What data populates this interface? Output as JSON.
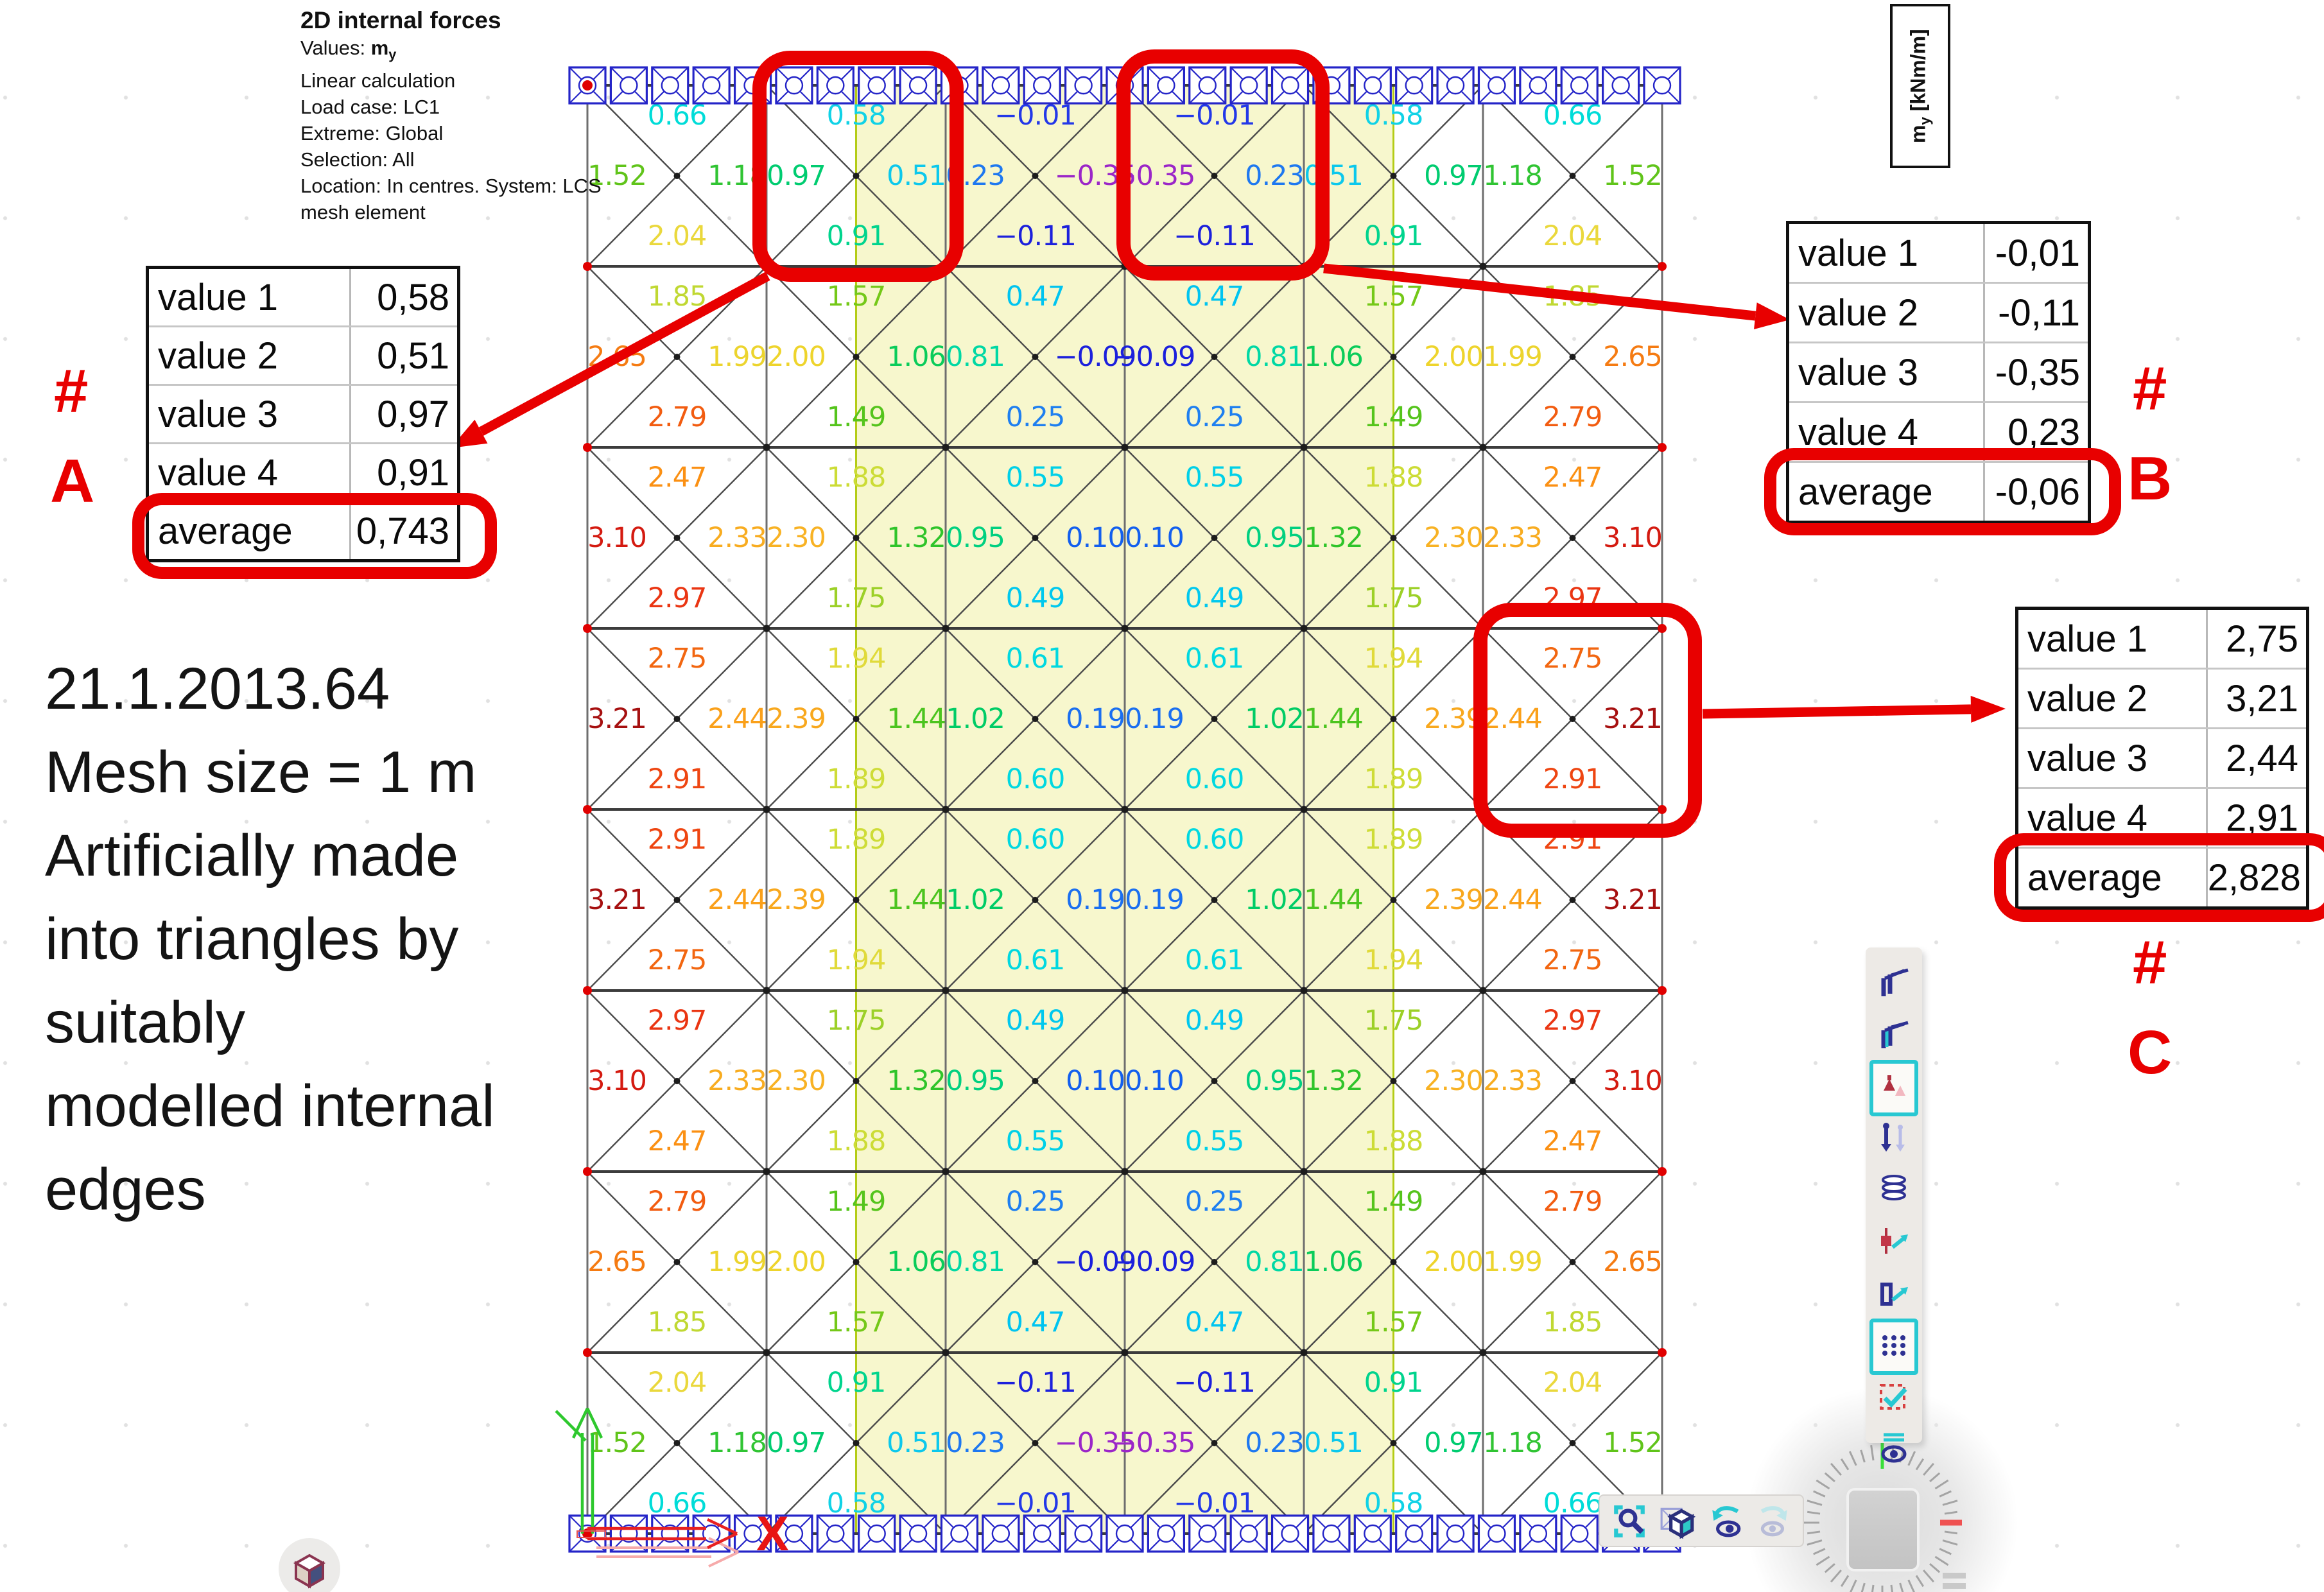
{
  "header": {
    "title": "2D internal forces",
    "values_prefix": "Values: ",
    "values_symbol": "m",
    "values_sub": "y",
    "lines": [
      "Linear calculation",
      "Load case: LC1",
      "Extreme: Global",
      "Selection: All",
      "Location: In centres. System: LCS",
      "mesh element"
    ]
  },
  "unit_box": {
    "symbol": "m",
    "subscript": "y",
    "rest": " [kNm/m]"
  },
  "note_lines": [
    "21.1.2013.64",
    "Mesh size = 1 m",
    "Artificially made",
    "into triangles by",
    "suitably",
    "modelled internal",
    "edges"
  ],
  "annotations": {
    "A": {
      "hash": "#",
      "letter": "A",
      "rows": [
        {
          "label": "value 1",
          "value": "0,58"
        },
        {
          "label": "value 2",
          "value": "0,51"
        },
        {
          "label": "value 3",
          "value": "0,97"
        },
        {
          "label": "value 4",
          "value": "0,91"
        },
        {
          "label": "average",
          "value": "0,743"
        }
      ]
    },
    "B": {
      "hash": "#",
      "letter": "B",
      "rows": [
        {
          "label": "value 1",
          "value": "-0,01"
        },
        {
          "label": "value 2",
          "value": "-0,11"
        },
        {
          "label": "value 3",
          "value": "-0,35"
        },
        {
          "label": "value 4",
          "value": "0,23"
        },
        {
          "label": "average",
          "value": "-0,06"
        }
      ]
    },
    "C": {
      "hash": "#",
      "letter": "C",
      "rows": [
        {
          "label": "value 1",
          "value": "2,75"
        },
        {
          "label": "value 2",
          "value": "3,21"
        },
        {
          "label": "value 3",
          "value": "2,44"
        },
        {
          "label": "value 4",
          "value": "2,91"
        },
        {
          "label": "average",
          "value": "2,828"
        }
      ]
    }
  },
  "axis": {
    "x_label": "X"
  },
  "toolbar_right": {
    "icons": [
      "beam-profile-icon",
      "beam-profile-teal-icon",
      "support-icon",
      "load-arrows-icon",
      "layers-icon",
      "mesh-node-icon",
      "mesh-element-icon",
      "mesh-grid-icon",
      "selection-check-icon",
      "visibility-icon"
    ],
    "highlighted": [
      "support-icon",
      "mesh-grid-icon"
    ]
  },
  "toolbar_bottom": {
    "icons": [
      "zoom-selection-icon",
      "cube-3d-icon",
      "undo-eye-icon",
      "redo-eye-icon"
    ]
  },
  "colors": {
    "accent_red": "#e80000",
    "support_blue": "#2424c8",
    "band_yellow": "#f7f7cd",
    "band_edge": "#b4cc16",
    "grid_dark": "#3c3c3c",
    "grid_gray": "#6e6e6e",
    "node_red": "#e00000",
    "teal": "#28c8d2",
    "navy": "#2e3192"
  },
  "chart_data": {
    "type": "heatmap",
    "title": "2D internal forces my [kNm/m] - FEM plate mesh, 6 x 8 squares of 1 m, each split into 4 triangles",
    "unit": "kNm/m",
    "value_range": [
      -0.35,
      3.21
    ],
    "legend_position": "none",
    "mesh": {
      "cols": 6,
      "rows": 8,
      "mesh_size_m": 1,
      "highlight_band_col_range": [
        1.5,
        4.5
      ],
      "supports": "line supports on top and bottom edges",
      "triangle_values": {
        "top": [
          [
            0.66,
            0.58,
            -0.01,
            -0.01,
            0.58,
            0.66
          ],
          [
            1.85,
            1.57,
            0.47,
            0.47,
            1.57,
            1.85
          ],
          [
            2.47,
            1.88,
            0.55,
            0.55,
            1.88,
            2.47
          ],
          [
            2.75,
            1.94,
            0.61,
            0.61,
            1.94,
            2.75
          ],
          [
            2.91,
            1.89,
            0.6,
            0.6,
            1.89,
            2.91
          ],
          [
            2.97,
            1.75,
            0.49,
            0.49,
            1.75,
            2.97
          ],
          [
            2.79,
            1.49,
            0.25,
            0.25,
            1.49,
            2.79
          ],
          [
            2.04,
            0.91,
            -0.11,
            -0.11,
            0.91,
            2.04
          ]
        ],
        "left": [
          [
            1.52,
            0.97,
            0.23,
            -0.35,
            0.51,
            1.18
          ],
          [
            2.65,
            2.0,
            0.81,
            -0.09,
            1.06,
            1.99
          ],
          [
            3.1,
            2.3,
            0.95,
            0.1,
            1.32,
            2.33
          ],
          [
            3.21,
            2.39,
            1.02,
            0.19,
            1.44,
            2.44
          ],
          [
            3.21,
            2.39,
            1.02,
            0.19,
            1.44,
            2.44
          ],
          [
            3.1,
            2.3,
            0.95,
            0.1,
            1.32,
            2.33
          ],
          [
            2.65,
            2.0,
            0.81,
            -0.09,
            1.06,
            1.99
          ],
          [
            1.52,
            0.97,
            0.23,
            -0.35,
            0.51,
            1.18
          ]
        ],
        "right": [
          [
            1.18,
            0.51,
            -0.35,
            0.23,
            0.97,
            1.52
          ],
          [
            1.99,
            1.06,
            -0.09,
            0.81,
            2.0,
            2.65
          ],
          [
            2.33,
            1.32,
            0.1,
            0.95,
            2.3,
            3.1
          ],
          [
            2.44,
            1.44,
            0.19,
            1.02,
            2.39,
            3.21
          ],
          [
            2.44,
            1.44,
            0.19,
            1.02,
            2.39,
            3.21
          ],
          [
            2.33,
            1.32,
            0.1,
            0.95,
            2.3,
            3.1
          ],
          [
            1.99,
            1.06,
            -0.09,
            0.81,
            2.0,
            2.65
          ],
          [
            1.18,
            0.51,
            -0.35,
            0.23,
            0.97,
            1.52
          ]
        ],
        "bottom": [
          [
            2.04,
            0.91,
            -0.11,
            -0.11,
            0.91,
            2.04
          ],
          [
            2.79,
            1.49,
            0.25,
            0.25,
            1.49,
            2.79
          ],
          [
            2.97,
            1.75,
            0.49,
            0.49,
            1.75,
            2.97
          ],
          [
            2.91,
            1.89,
            0.6,
            0.6,
            1.89,
            2.91
          ],
          [
            2.75,
            1.94,
            0.61,
            0.61,
            1.94,
            2.75
          ],
          [
            2.47,
            1.88,
            0.55,
            0.55,
            1.88,
            2.47
          ],
          [
            1.85,
            1.57,
            0.47,
            0.47,
            1.57,
            1.85
          ],
          [
            0.66,
            0.58,
            -0.01,
            -0.01,
            0.58,
            0.66
          ]
        ]
      },
      "highlight_squares": [
        {
          "row": 1,
          "col": 2,
          "label": "A"
        },
        {
          "row": 1,
          "col": 4,
          "label": "B"
        },
        {
          "row": 4,
          "col": 6,
          "label": "C"
        }
      ]
    },
    "value_colors": {
      "-0.35": "#9b26c8",
      "-0.11": "#1c20dc",
      "-0.09": "#1c20dc",
      "-0.01": "#2338e8",
      "0.10": "#135fee",
      "0.19": "#1b6ff0",
      "0.23": "#1e78f0",
      "0.25": "#1e7ff0",
      "0.47": "#00c4f0",
      "0.49": "#00c8ee",
      "0.51": "#0cc8ec",
      "0.55": "#00d0e8",
      "0.58": "#10d2e6",
      "0.60": "#00d8e0",
      "0.61": "#00d8e0",
      "0.66": "#00dcd8",
      "0.81": "#00d8a4",
      "0.91": "#00d48d",
      "0.95": "#00d080",
      "0.97": "#00cc70",
      "1.02": "#00cc66",
      "1.06": "#0acc5a",
      "1.18": "#30c433",
      "1.32": "#2fc42a",
      "1.44": "#4cc41f",
      "1.49": "#55c41c",
      "1.52": "#60c41a",
      "1.57": "#74c818",
      "1.75": "#9cd028",
      "1.85": "#c0d832",
      "1.88": "#ccdc36",
      "1.89": "#cedc37",
      "1.94": "#e0da3a",
      "1.99": "#ecd42e",
      "2.00": "#eed42c",
      "2.04": "#ead83c",
      "2.30": "#f8b224",
      "2.33": "#f8ac20",
      "2.39": "#f8a81e",
      "2.44": "#faa01a",
      "2.47": "#fb9013",
      "2.65": "#f57b12",
      "2.75": "#f26610",
      "2.79": "#f25c10",
      "2.91": "#ee4511",
      "2.97": "#ea3512",
      "3.10": "#d41a10",
      "3.21": "#a61010"
    }
  }
}
